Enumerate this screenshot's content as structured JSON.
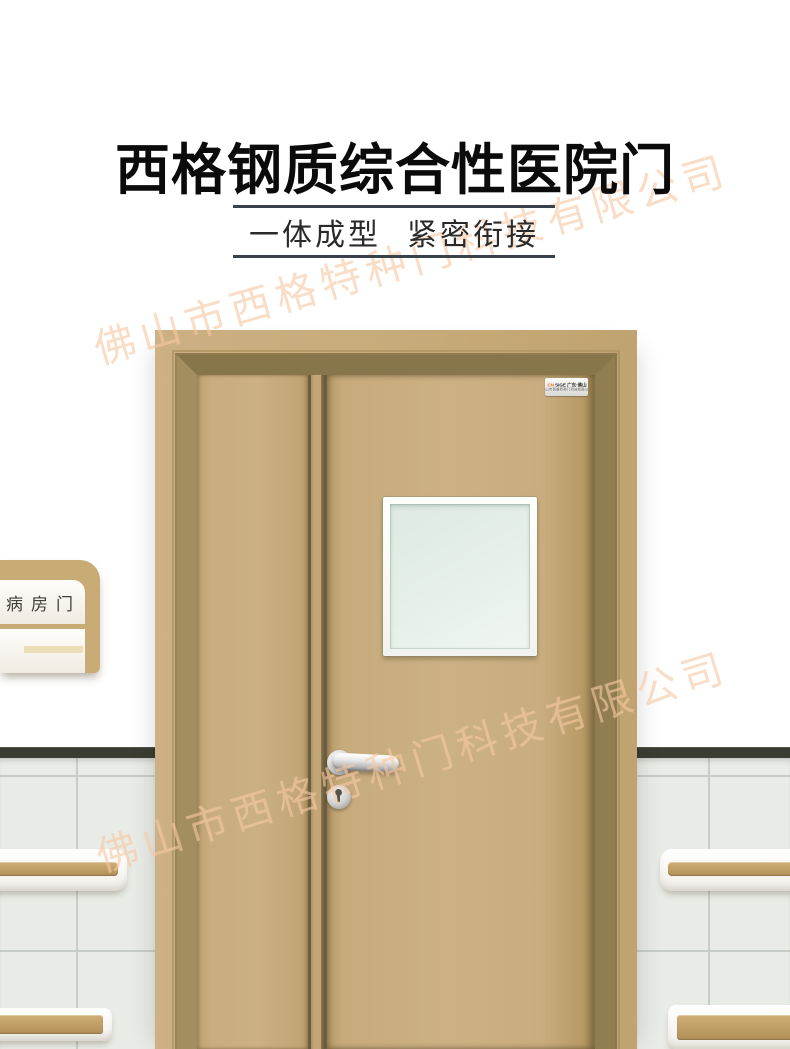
{
  "header": {
    "title": "西格钢质综合性医院门",
    "subtitle_left": "一体成型",
    "subtitle_right": "紧密衔接"
  },
  "watermark": {
    "text": "佛山市西格特种门科技有限公司",
    "color": "#f6c9a4"
  },
  "scene": {
    "sign": {
      "label": "病房门"
    },
    "door": {
      "plate_line1_prefix": "CN",
      "plate_line1": " SIGE 广东·佛山",
      "plate_line2": "佛山市西格特种门科技有限公司"
    },
    "colors": {
      "door_tan": "#c9ad7f",
      "frame_tan": "#c8ab7a",
      "rail_tan": "#c2a268",
      "dado_dark": "#3b3d33",
      "tile": "#e9ece6",
      "glass_green": "#e3eee8",
      "rule_dark": "#39424a",
      "title_black": "#0b0b0b",
      "watermark_peach": "#f6c9a4"
    }
  }
}
